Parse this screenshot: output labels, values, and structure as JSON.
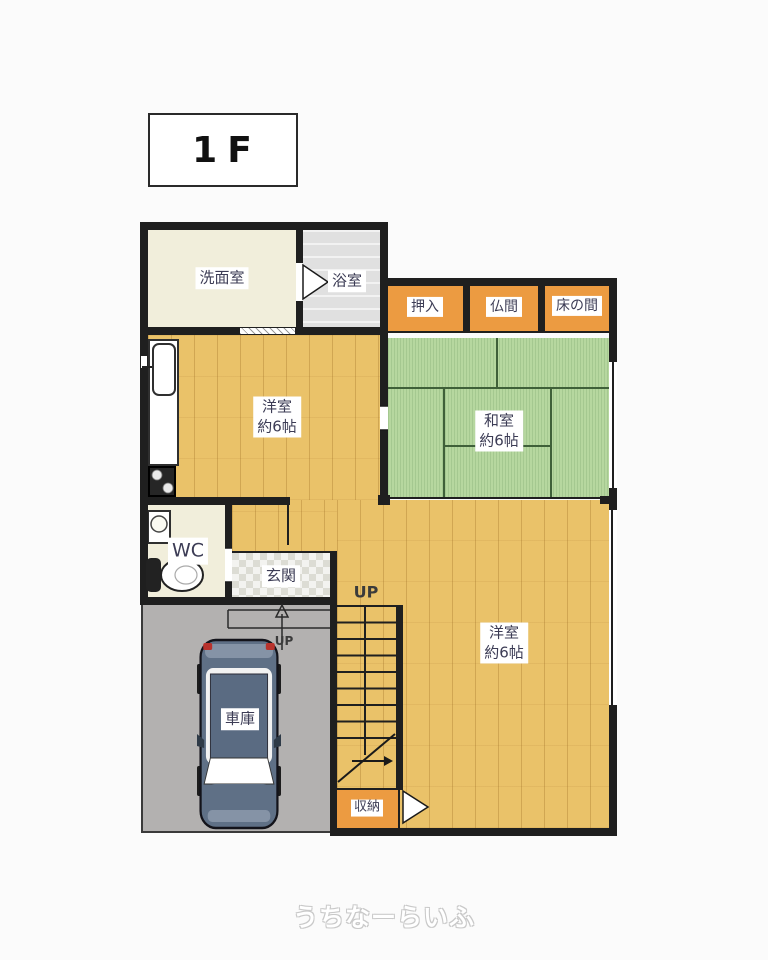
{
  "floor_indicator": {
    "label": "1F"
  },
  "watermark": {
    "text": "うちなーらいふ"
  },
  "rooms": {
    "washroom": {
      "label": "洗面室"
    },
    "bathroom": {
      "label": "浴室"
    },
    "closet": {
      "label": "押入"
    },
    "butsuma": {
      "label": "仏間"
    },
    "tokonoma": {
      "label": "床の間"
    },
    "japanese_room": {
      "label": "和室",
      "size": "約6帖"
    },
    "western_room_kitchen": {
      "label": "洋室",
      "size": "約6帖"
    },
    "western_room_south": {
      "label": "洋室",
      "size": "約6帖"
    },
    "toilet": {
      "label": "WC"
    },
    "entrance": {
      "label": "玄関"
    },
    "garage": {
      "label": "車庫"
    },
    "storage": {
      "label": "収納"
    }
  },
  "stairs": {
    "up_label": "UP"
  },
  "entrance_step": {
    "up_label": "UP"
  },
  "colors": {
    "wood_floor": "#eac269",
    "tatami_green": "#b6d79f",
    "closet_orange": "#ec9b41",
    "cream_room": "#f1eedb",
    "bath_gray": "#e0e0e0",
    "garage_gray": "#b3b1b0",
    "wall_black": "#1f1f1f",
    "label_text": "#3c3c55"
  }
}
